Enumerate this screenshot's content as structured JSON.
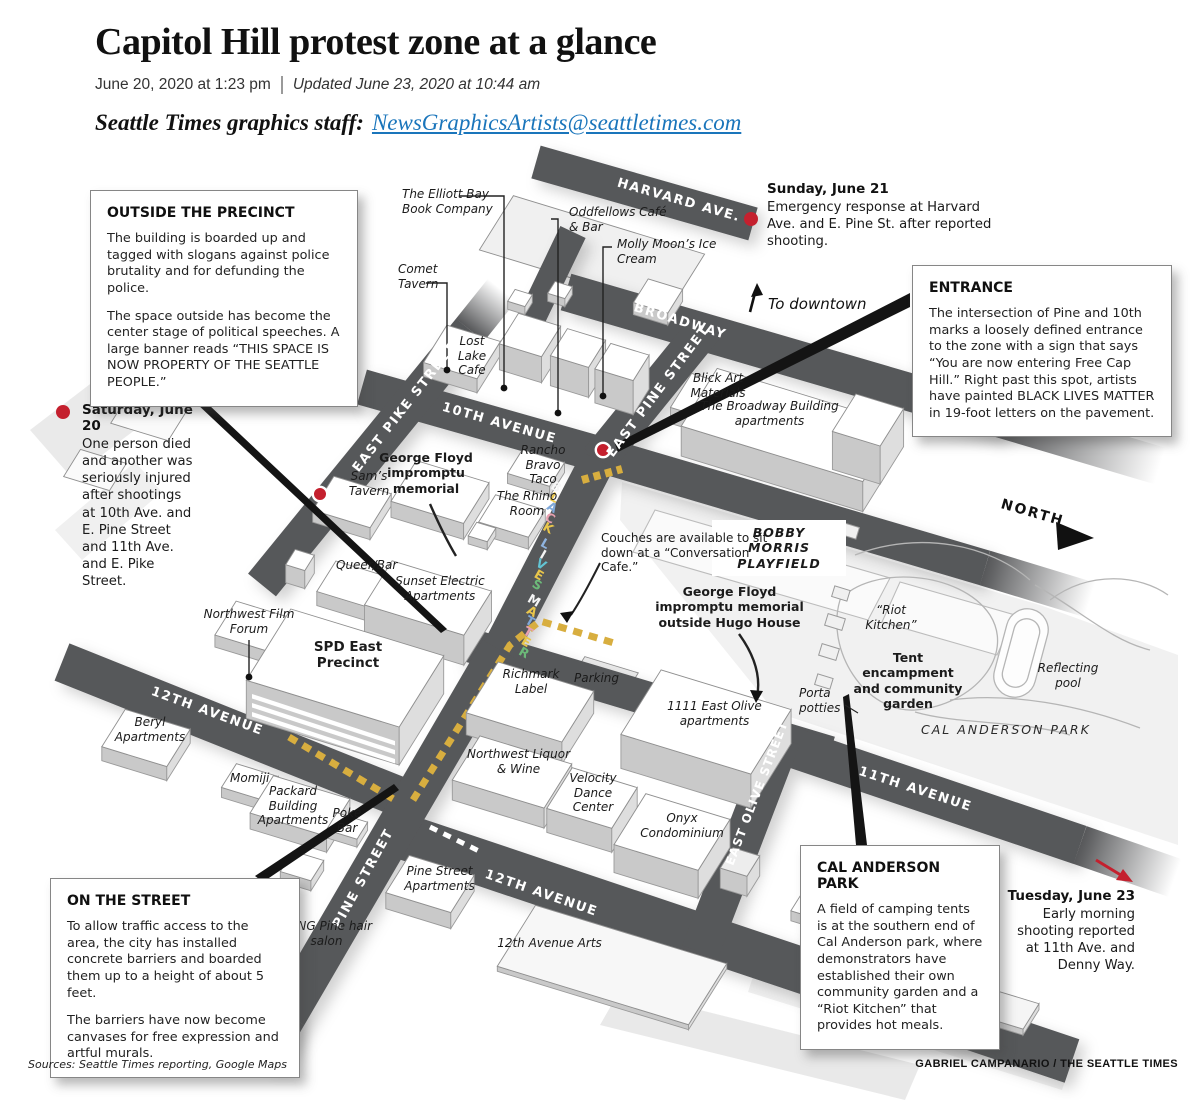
{
  "header": {
    "title": "Capitol Hill protest zone at a glance",
    "published": "June 20, 2020 at 1:23 pm",
    "updated": "Updated June 23, 2020 at 10:44 am",
    "byline_label": "Seattle Times graphics staff:",
    "byline_email": "NewsGraphicsArtists@seattletimes.com"
  },
  "callouts": {
    "outside": {
      "heading": "OUTSIDE  THE PRECINCT",
      "p1": "The building is boarded up and tagged with slogans against police brutality and for defunding the police.",
      "p2": "The space outside has become the center stage of political speeches. A large banner reads “THIS SPACE IS NOW PROPERTY OF THE SEATTLE PEOPLE.”"
    },
    "entrance": {
      "heading": "ENTRANCE",
      "p1": "The intersection of Pine and 10th marks a loosely defined entrance to the zone with a sign that says “You are now entering Free Cap Hill.” Right past this spot, artists have painted BLACK LIVES MATTER in 19-foot letters on the pavement."
    },
    "street": {
      "heading": "ON THE STREET",
      "p1": "To allow traffic access to the area, the city has installed concrete barriers and boarded them up to a height of about 5 feet.",
      "p2": "The barriers have now become canvases for free expression and artful murals."
    },
    "park": {
      "heading": "CAL ANDERSON PARK",
      "p1": "A field of camping tents is at the southern end of Cal Anderson park, where demonstrators have established their own community garden and a “Riot Kitchen” that provides hot meals."
    }
  },
  "incidents": {
    "saturday": {
      "title": "Saturday, June 20",
      "body": "One person died and another was seriously injured after shootings at 10th Ave. and E. Pine Street and 11th Ave. and E. Pike Street."
    },
    "sunday": {
      "title": "Sunday, June 21",
      "body": "Emergency response at Harvard Ave. and E. Pine St. after reported shooting."
    },
    "tuesday": {
      "title": "Tuesday, June 23",
      "body": "Early morning shooting reported at 11th Ave. and Denny Way."
    }
  },
  "streets": {
    "harvard": "HARVARD AVE.",
    "broadway": "BROADWAY",
    "east_pike": "EAST PIKE STREET",
    "tenth": "10TH AVENUE",
    "east_pine": "EAST PINE STREET",
    "twelfth_nw": "12TH AVENUE",
    "pine": "PINE STREET",
    "twelfth_s": "12TH AVENUE",
    "east_olive": "EAST OLIVE STREET",
    "eleventh": "11TH AVENUE"
  },
  "places": {
    "elliott_bay": "The Elliott Bay Book Company",
    "comet": "Comet Tavern",
    "oddfellows": "Oddfellows Café & Bar",
    "molly_moons": "Molly Moon’s Ice Cream",
    "lost_lake": "Lost Lake Cafe",
    "sams": "Sam’s Tavern",
    "gf_memorial": "George Floyd impromptu memorial",
    "rancho": "Rancho Bravo Taco",
    "rhino": "The Rhino Room",
    "blick": "Blick Art Materials",
    "broadway_building": "The Broadway Building apartments",
    "queer_bar": "Queer/Bar",
    "sunset_electric": "Sunset Electric Apartments",
    "nw_film_forum": "Northwest Film Forum",
    "spd": "SPD East Precinct",
    "beryl": "Beryl Apartments",
    "momiji": "Momiji",
    "packard": "Packard Building Apartments",
    "poke": "Poke Bar",
    "bang": "BANG Pine hair salon",
    "pine_apts": "Pine Street Apartments",
    "twelfth_arts": "12th Avenue Arts",
    "richmark": "Richmark Label",
    "parking": "Parking",
    "east_olive_apts": "1111 East Olive apartments",
    "nw_liquor": "Northwest Liquor & Wine",
    "velocity": "Velocity Dance Center",
    "onyx": "Onyx Condominium",
    "riot_kitchen": "“Riot Kitchen”",
    "tent": "Tent encampment and community garden",
    "porta": "Porta potties",
    "reflecting": "Reflecting pool",
    "cal_park": "CAL ANDERSON PARK",
    "bobby": "BOBBY MORRIS PLAYFIELD",
    "couches": "Couches are available to sit down at a “Conversation Cafe.”",
    "hugo": "George Floyd impromptu memorial outside Hugo House"
  },
  "compass": {
    "north": "NORTH",
    "downtown": "To downtown"
  },
  "colors": {
    "street": "#57585a",
    "barrier_yellow": "#d8ae3f",
    "incident_red": "#c4202e",
    "link_blue": "#1a75bb"
  },
  "blm": {
    "letters": [
      {
        "ch": "B",
        "color": "#f5f5f5"
      },
      {
        "ch": "L",
        "color": "#e9c64b"
      },
      {
        "ch": "A",
        "color": "#7fa8d9"
      },
      {
        "ch": "C",
        "color": "#e8a0b0"
      },
      {
        "ch": "K",
        "color": "#e9c64b"
      },
      {
        "ch": "L",
        "color": "#8fb4e0",
        "gap": true
      },
      {
        "ch": "I",
        "color": "#f5f5f5"
      },
      {
        "ch": "V",
        "color": "#62c4d4"
      },
      {
        "ch": "E",
        "color": "#e9c64b"
      },
      {
        "ch": "S",
        "color": "#6cb979"
      },
      {
        "ch": "M",
        "color": "#f5f5f5",
        "gap": true
      },
      {
        "ch": "A",
        "color": "#e9c64b"
      },
      {
        "ch": "T",
        "color": "#7fa8d9"
      },
      {
        "ch": "T",
        "color": "#e8a0b0"
      },
      {
        "ch": "E",
        "color": "#e9c64b"
      },
      {
        "ch": "R",
        "color": "#6cb979"
      }
    ]
  },
  "footer": {
    "sources": "Sources: Seattle Times reporting, Google Maps",
    "credit": "GABRIEL CAMPANARIO / THE SEATTLE TIMES"
  }
}
